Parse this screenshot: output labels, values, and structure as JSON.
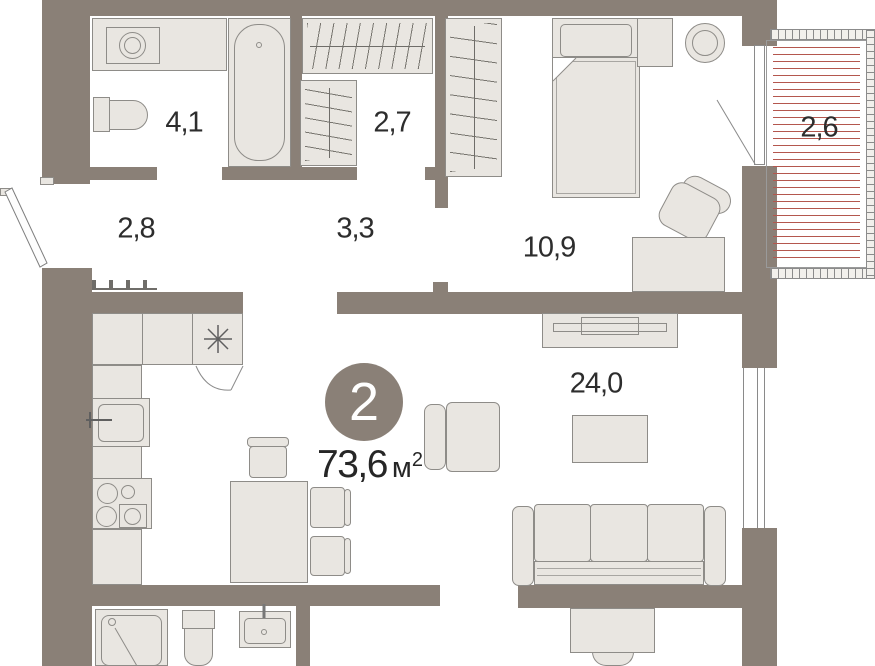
{
  "badge": {
    "rooms_count": "2"
  },
  "total_area": {
    "value": "73,6",
    "unit": "м",
    "sup": "2"
  },
  "rooms": [
    {
      "name": "bathroom",
      "area": "4,1"
    },
    {
      "name": "dressing-room",
      "area": "2,7"
    },
    {
      "name": "hallway",
      "area": "2,8"
    },
    {
      "name": "corridor",
      "area": "3,3"
    },
    {
      "name": "bedroom",
      "area": "10,9"
    },
    {
      "name": "balcony",
      "area": "2,6"
    },
    {
      "name": "living-room",
      "area": "24,0"
    }
  ],
  "colors": {
    "wall": "#8a8077",
    "furniture_fill": "#e9e6e1",
    "outline": "#8e8c88",
    "balcony_heat_lines": "#b4574e",
    "label_text": "#2d2d2d",
    "badge_bg": "#8a8077",
    "badge_text": "#ffffff"
  },
  "icons": {
    "fridge_spot": "asterisk-snowflake"
  }
}
